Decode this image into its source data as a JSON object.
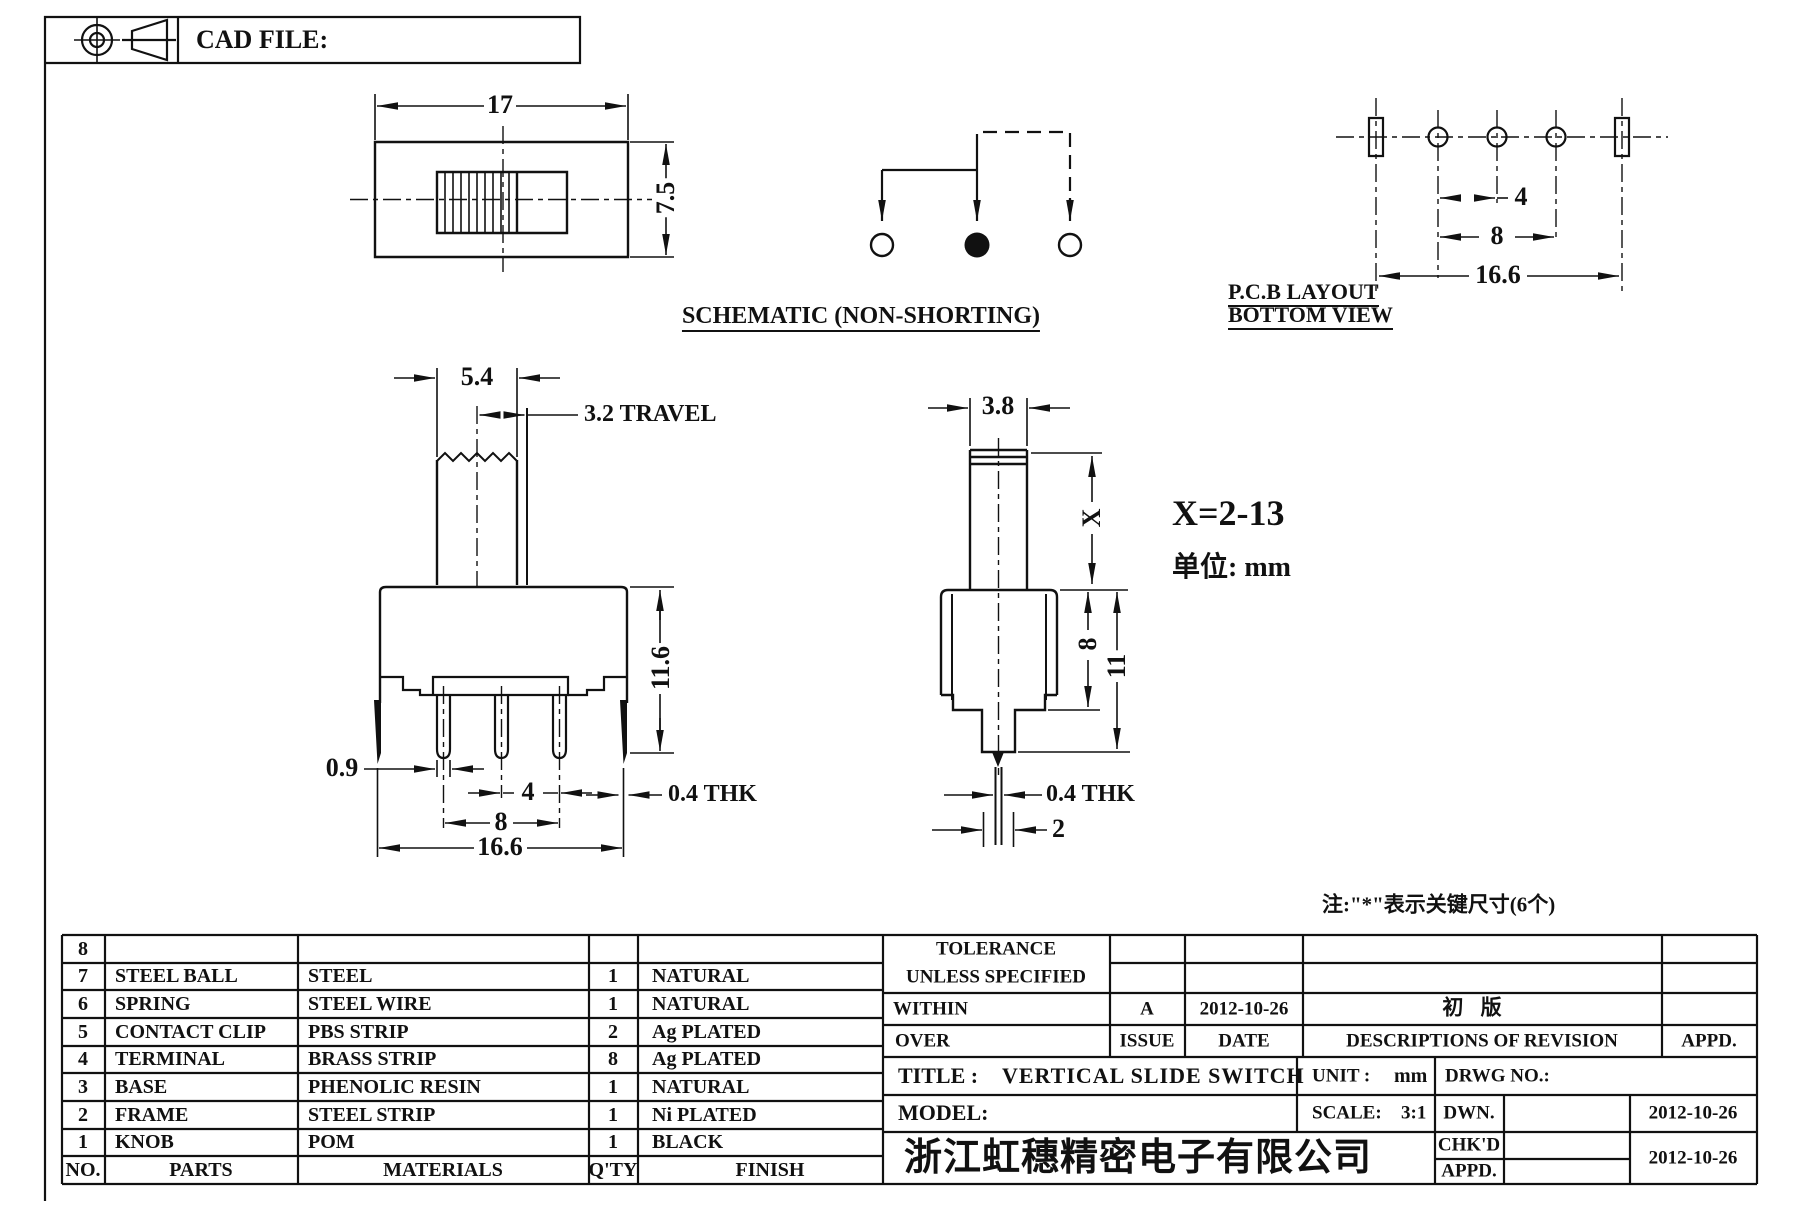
{
  "header": {
    "cad_file": "CAD FILE:"
  },
  "views": {
    "top": {
      "dim_w": "17",
      "dim_h": "7.5"
    },
    "schematic": {
      "label": "SCHEMATIC (NON-SHORTING)"
    },
    "pcb": {
      "dim_pitch": "4",
      "dim_span": "8",
      "dim_total": "16.6",
      "label1": "P.C.B LAYOUT",
      "label2": "BOTTOM VIEW"
    },
    "front": {
      "dim_knob": "5.4",
      "dim_travel": "3.2 TRAVEL",
      "dim_pin": "0.9",
      "dim_pitch": "4",
      "dim_span": "8",
      "dim_total": "16.6",
      "dim_height": "11.6",
      "dim_thk": "0.4 THK"
    },
    "side": {
      "dim_knob": "3.8",
      "dim_x": "X",
      "dim_upper": "8",
      "dim_total": "11",
      "dim_thk": "0.4 THK",
      "dim_pin": "2"
    }
  },
  "notes": {
    "x_range": "X=2-13",
    "unit": "单位: mm",
    "key": "注:\"*\"表示关键尺寸(6个)"
  },
  "parts_table": {
    "headers": {
      "no": "NO.",
      "parts": "PARTS",
      "materials": "MATERIALS",
      "qty": "Q'TY",
      "finish": "FINISH"
    },
    "rows": [
      {
        "no": "8",
        "parts": "",
        "materials": "",
        "qty": "",
        "finish": ""
      },
      {
        "no": "7",
        "parts": "STEEL BALL",
        "materials": "STEEL",
        "qty": "1",
        "finish": "NATURAL"
      },
      {
        "no": "6",
        "parts": "SPRING",
        "materials": "STEEL WIRE",
        "qty": "1",
        "finish": "NATURAL"
      },
      {
        "no": "5",
        "parts": "CONTACT CLIP",
        "materials": "PBS STRIP",
        "qty": "2",
        "finish": "Ag PLATED"
      },
      {
        "no": "4",
        "parts": "TERMINAL",
        "materials": "BRASS STRIP",
        "qty": "8",
        "finish": "Ag PLATED"
      },
      {
        "no": "3",
        "parts": "BASE",
        "materials": "PHENOLIC RESIN",
        "qty": "1",
        "finish": "NATURAL"
      },
      {
        "no": "2",
        "parts": "FRAME",
        "materials": "STEEL STRIP",
        "qty": "1",
        "finish": "Ni PLATED"
      },
      {
        "no": "1",
        "parts": "KNOB",
        "materials": "POM",
        "qty": "1",
        "finish": "BLACK"
      }
    ]
  },
  "revision": {
    "tol1": "TOLERANCE",
    "tol2": "UNLESS  SPECIFIED",
    "within": "WITHIN",
    "over": "OVER",
    "issue": "A",
    "date": "2012-10-26",
    "desc": "初  版",
    "issue_label": "ISSUE",
    "date_label": "DATE",
    "desc_label": "DESCRIPTIONS OF REVISION",
    "appd_label": "APPD."
  },
  "title_block": {
    "title_label": "TITLE :",
    "title": "VERTICAL SLIDE SWITCH",
    "unit_label": "UNIT :",
    "unit": "mm",
    "drwg_label": "DRWG NO.:",
    "model_label": "MODEL:",
    "scale_label": "SCALE:",
    "scale": "3:1",
    "company": "浙江虹穗精密电子有限公司",
    "dwn_label": "DWN.",
    "chkd_label": "CHK'D",
    "appd_label": "APPD.",
    "dwn_date": "2012-10-26",
    "chkd_date": "2012-10-26"
  }
}
